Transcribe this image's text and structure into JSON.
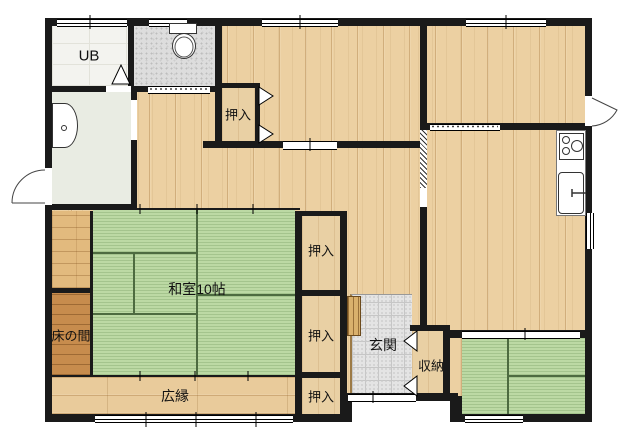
{
  "plan": {
    "labels": {
      "ub": "UB",
      "oshiire_top": "押入",
      "oshiire_upper": "押入",
      "oshiire_lower": "押入",
      "oshiire_hiroen": "押入",
      "washitsu": "和室10帖",
      "tokonoma": "床の間",
      "hiroen": "広縁",
      "genkan": "玄関",
      "shuno": "収納"
    },
    "fixtures": [
      "toilet",
      "wash-basin",
      "stove",
      "kitchen-sink",
      "entrance-step",
      "kitchen-counter"
    ],
    "colors": {
      "wall": "#1a1a1a",
      "wood_floor": "#ecd0a2",
      "veranda_floor": "#e9cb9b",
      "tatami": "#bcd9a4",
      "tokonoma_wood": "#c78c4d",
      "cabinet_wood": "#e2ba7e",
      "entry_tile": "#e4e4e4",
      "toilet_floor": "#dddddd",
      "washroom_floor": "#e9ece3",
      "bath_floor": "#f3f3ef"
    }
  }
}
